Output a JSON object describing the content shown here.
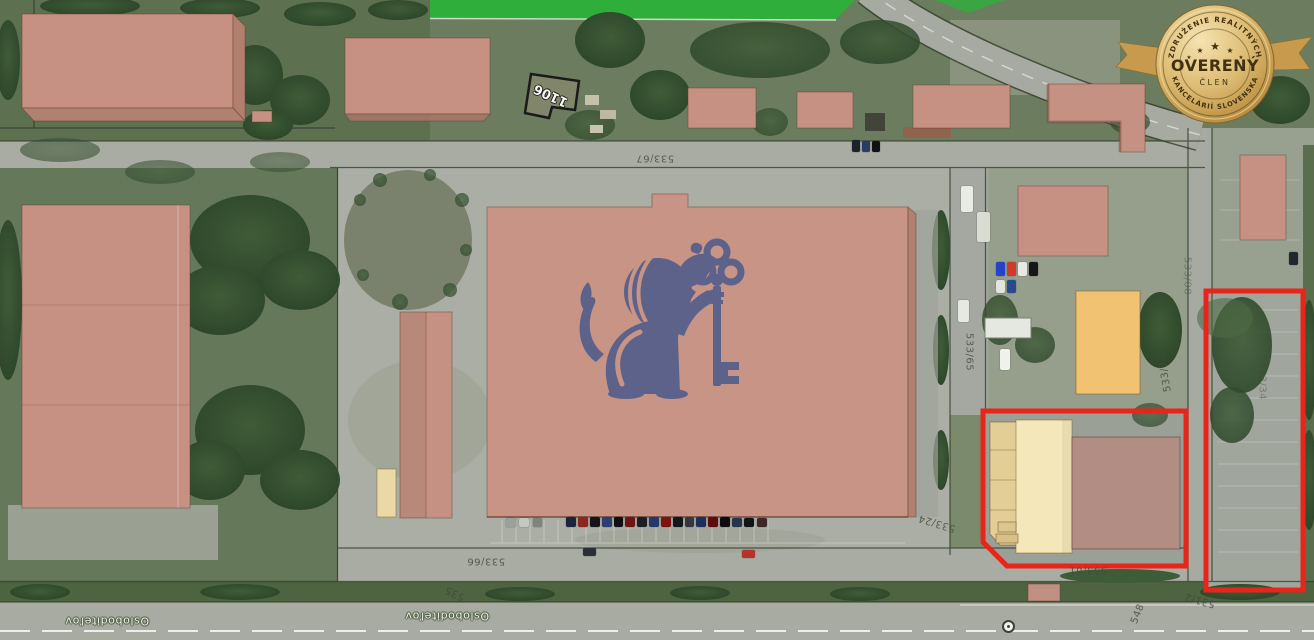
{
  "image_type": "aerial-cadastral-property-view",
  "badge": {
    "top_text": "ZDRUŽENIE REALITNÝCH",
    "main_text": "OVERENÝ",
    "sub_text": "ČLEN",
    "bottom_text": "KANCELÁRIÍ SLOVENSKA",
    "star": "★",
    "gold_color": "#d9b96e",
    "text_color": "#42310f"
  },
  "watermark": {
    "name": "lion-holding-key-logo",
    "color": "#59618a"
  },
  "highlight": {
    "color": "#e8251a"
  },
  "colors": {
    "building_salmon": "#c69183",
    "building_orange": "#f1c272",
    "building_cream": "#f4e7ba",
    "building_mauve": "#b18d83",
    "road_gray": "#a9aca2",
    "grass_green": "#5d7050",
    "verge_green": "#4e6340",
    "bright_green": "#2fae3c"
  },
  "map": {
    "street_labels": [
      {
        "text": "Osloboditeľov",
        "x": 107,
        "y": 621,
        "rot": 180
      },
      {
        "text": "Osloboditeľov",
        "x": 447,
        "y": 616,
        "rot": 180
      }
    ],
    "parcel_labels": [
      {
        "text": "533/67",
        "x": 655,
        "y": 158,
        "rot": 180
      },
      {
        "text": "533/65",
        "x": 969,
        "y": 352,
        "rot": 90
      },
      {
        "text": "533/71",
        "x": 1165,
        "y": 373,
        "rot": -100
      },
      {
        "text": "533/24",
        "x": 937,
        "y": 523,
        "rot": 197
      },
      {
        "text": "533/66",
        "x": 486,
        "y": 561,
        "rot": 180
      },
      {
        "text": "535",
        "x": 455,
        "y": 593,
        "rot": 205
      },
      {
        "text": "533/61",
        "x": 1088,
        "y": 570,
        "rot": 180
      },
      {
        "text": "531/2",
        "x": 1200,
        "y": 600,
        "rot": 195
      },
      {
        "text": "548",
        "x": 1138,
        "y": 614,
        "rot": -68
      },
      {
        "text": "533/34",
        "x": 1262,
        "y": 381,
        "rot": 90,
        "faint": true
      },
      {
        "text": "533/08",
        "x": 1187,
        "y": 276,
        "rot": 90,
        "faint": true
      },
      {
        "text": "533/68",
        "x": 2,
        "y": 345,
        "rot": 90,
        "faint": true
      }
    ],
    "building_labels": [
      {
        "text": "1106",
        "x": 551,
        "y": 95,
        "rot": 205
      }
    ],
    "vehicles": [
      {
        "x": 506,
        "y": 518,
        "w": 10,
        "h": 9,
        "c": "#9aa09a"
      },
      {
        "x": 519,
        "y": 518,
        "w": 10,
        "h": 9,
        "c": "#c4c8c0"
      },
      {
        "x": 533,
        "y": 518,
        "w": 9,
        "h": 9,
        "c": "#7e847e"
      },
      {
        "x": 566,
        "y": 517,
        "w": 10,
        "h": 10,
        "c": "#1a2440"
      },
      {
        "x": 578,
        "y": 517,
        "w": 10,
        "h": 10,
        "c": "#8c2620"
      },
      {
        "x": 590,
        "y": 517,
        "w": 10,
        "h": 10,
        "c": "#14151b"
      },
      {
        "x": 602,
        "y": 517,
        "w": 10,
        "h": 10,
        "c": "#2c3f74"
      },
      {
        "x": 614,
        "y": 517,
        "w": 9,
        "h": 10,
        "c": "#0f1014"
      },
      {
        "x": 625,
        "y": 517,
        "w": 10,
        "h": 10,
        "c": "#6e1511"
      },
      {
        "x": 637,
        "y": 517,
        "w": 10,
        "h": 10,
        "c": "#1a1e26"
      },
      {
        "x": 649,
        "y": 517,
        "w": 10,
        "h": 10,
        "c": "#23386b"
      },
      {
        "x": 661,
        "y": 517,
        "w": 10,
        "h": 10,
        "c": "#7d120e"
      },
      {
        "x": 673,
        "y": 517,
        "w": 10,
        "h": 10,
        "c": "#12161d"
      },
      {
        "x": 685,
        "y": 517,
        "w": 9,
        "h": 10,
        "c": "#343841"
      },
      {
        "x": 696,
        "y": 517,
        "w": 10,
        "h": 10,
        "c": "#1c2f5d"
      },
      {
        "x": 708,
        "y": 517,
        "w": 10,
        "h": 10,
        "c": "#5f0d0a"
      },
      {
        "x": 720,
        "y": 517,
        "w": 10,
        "h": 10,
        "c": "#0c0d10"
      },
      {
        "x": 732,
        "y": 518,
        "w": 10,
        "h": 9,
        "c": "#27344f"
      },
      {
        "x": 744,
        "y": 518,
        "w": 10,
        "h": 9,
        "c": "#101318"
      },
      {
        "x": 757,
        "y": 518,
        "w": 10,
        "h": 9,
        "c": "#3d2a28"
      },
      {
        "x": 583,
        "y": 548,
        "w": 13,
        "h": 8,
        "c": "#2a2e36"
      },
      {
        "x": 742,
        "y": 550,
        "w": 13,
        "h": 8,
        "c": "#b5342a"
      },
      {
        "x": 852,
        "y": 140,
        "w": 8,
        "h": 12,
        "c": "#1d2129"
      },
      {
        "x": 862,
        "y": 141,
        "w": 8,
        "h": 11,
        "c": "#2b3b66"
      },
      {
        "x": 872,
        "y": 141,
        "w": 8,
        "h": 11,
        "c": "#101218"
      },
      {
        "x": 961,
        "y": 186,
        "w": 12,
        "h": 26,
        "c": "#e9ebe5"
      },
      {
        "x": 977,
        "y": 212,
        "w": 13,
        "h": 30,
        "c": "#d9dcd3"
      },
      {
        "x": 958,
        "y": 300,
        "w": 11,
        "h": 22,
        "c": "#e6e8e2"
      },
      {
        "x": 1000,
        "y": 349,
        "w": 10,
        "h": 21,
        "c": "#eff1eb"
      },
      {
        "x": 996,
        "y": 262,
        "w": 9,
        "h": 14,
        "c": "#2343c9"
      },
      {
        "x": 1007,
        "y": 262,
        "w": 9,
        "h": 14,
        "c": "#cf3b28"
      },
      {
        "x": 1018,
        "y": 262,
        "w": 9,
        "h": 14,
        "c": "#e8e8e4"
      },
      {
        "x": 1029,
        "y": 262,
        "w": 9,
        "h": 14,
        "c": "#15161a"
      },
      {
        "x": 996,
        "y": 280,
        "w": 9,
        "h": 13,
        "c": "#e2e4de"
      },
      {
        "x": 1007,
        "y": 280,
        "w": 9,
        "h": 13,
        "c": "#274a8f"
      },
      {
        "x": 1289,
        "y": 252,
        "w": 9,
        "h": 13,
        "c": "#23262e"
      }
    ]
  }
}
